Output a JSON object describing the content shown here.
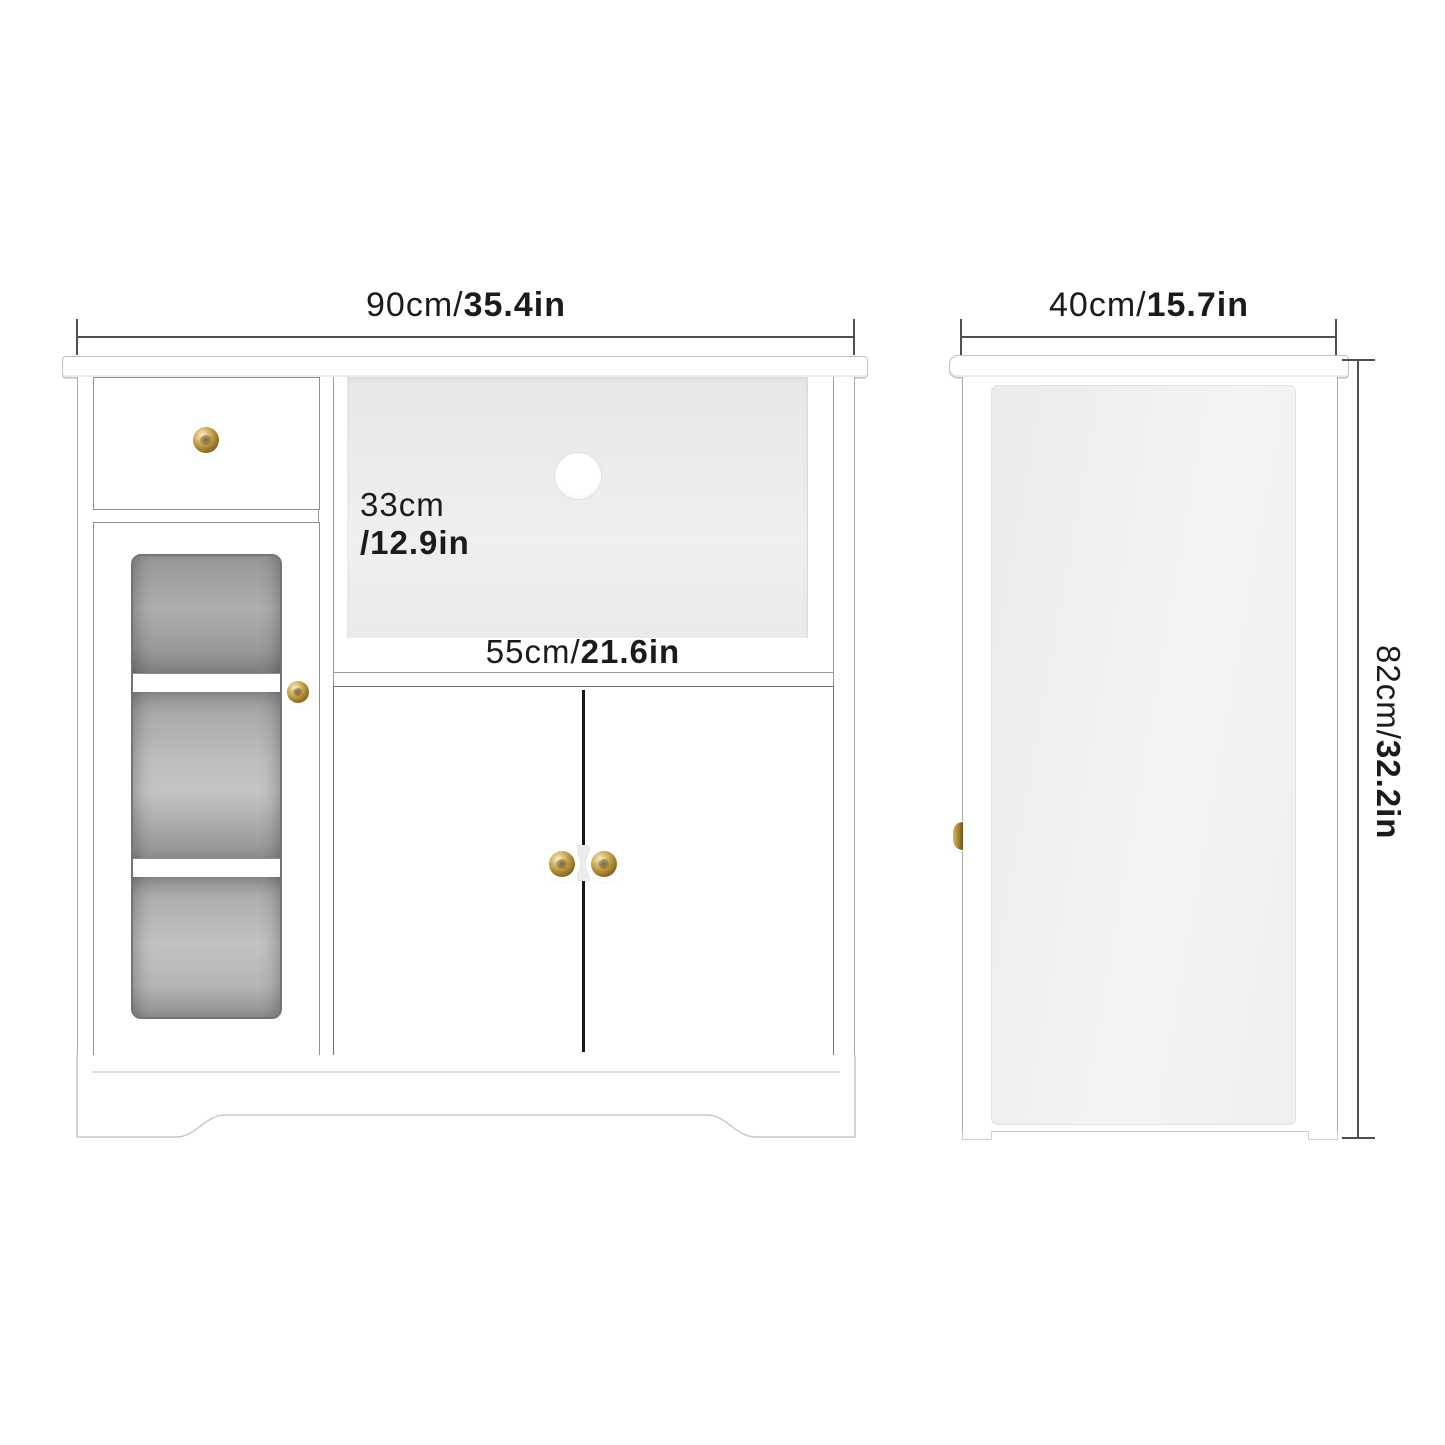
{
  "front_view": {
    "width_dim": {
      "metric": "90cm/",
      "imperial": "35.4in"
    },
    "opening_height_dim": {
      "line1": "33cm",
      "line2": "/12.9in"
    },
    "opening_width_dim": {
      "metric": "55cm/",
      "imperial": "21.6in"
    }
  },
  "side_view": {
    "depth_dim": {
      "metric": "40cm/",
      "imperial": "15.7in"
    },
    "height_dim": {
      "metric": "82cm/",
      "imperial": "32.2in"
    }
  },
  "colors": {
    "brass_knob": "#b08a33",
    "dimension_line": "#4f4f4f",
    "label_text": "#1b1b1b",
    "glass_tint": "#a9a9a9",
    "side_panel": "#f0f0f0",
    "open_shelf_back": "#ececec"
  }
}
